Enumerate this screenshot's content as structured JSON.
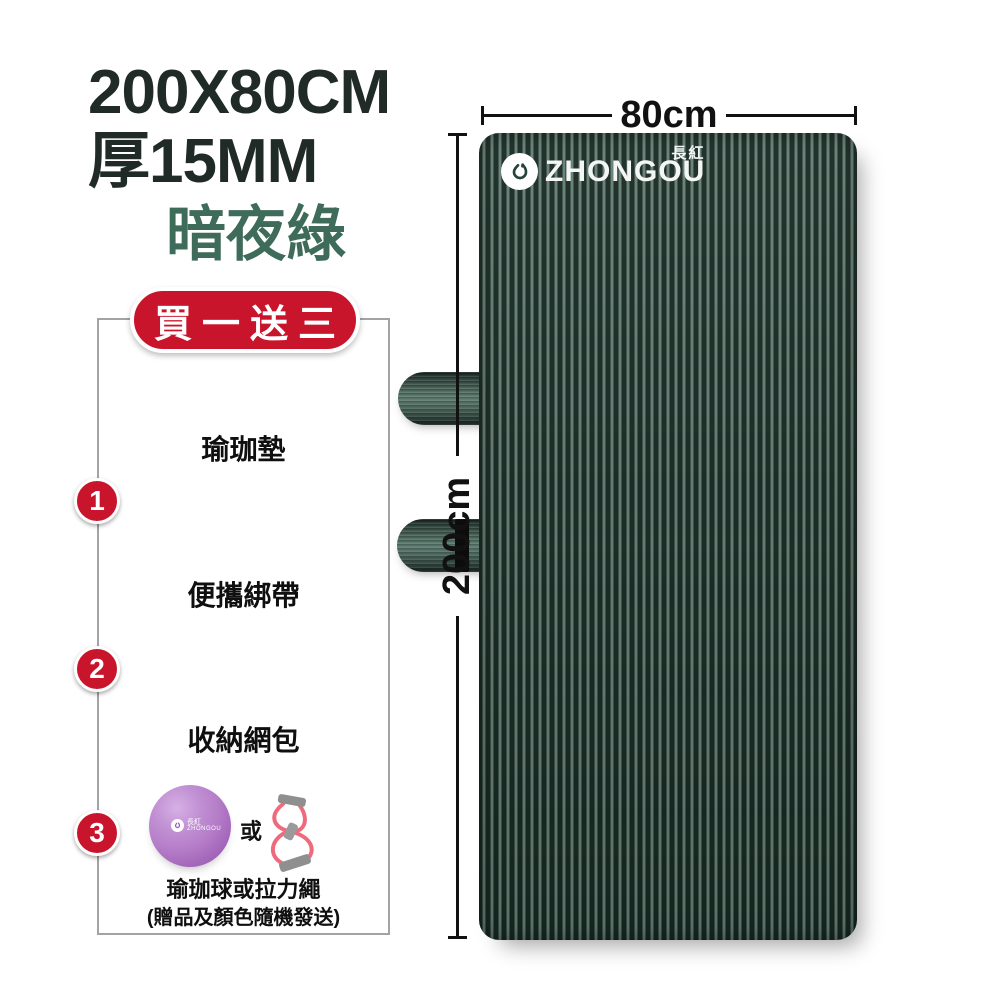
{
  "product": {
    "size_title": "200X80CM",
    "thickness_title": "厚15MM",
    "color_name": "暗夜綠"
  },
  "bundle": {
    "badge_label": "買一送三",
    "plus_symbol": "+",
    "main_item_label": "瑜珈墊",
    "gifts": [
      {
        "number": "1",
        "label": "便攜綁帶"
      },
      {
        "number": "2",
        "label": "收納網包"
      },
      {
        "number": "3",
        "label": "瑜珈球或拉力繩"
      }
    ],
    "or_text": "或",
    "gift_note": "(贈品及顏色隨機發送)"
  },
  "mat_preview": {
    "width_label": "80cm",
    "height_label": "200cm",
    "brand_cn": "長紅",
    "brand_en": "ZHONGOU"
  },
  "ball": {
    "brand_cn": "長紅",
    "brand_en": "ZHONGOU"
  },
  "colors": {
    "accent_red": "#c9152b",
    "title_text": "#202b27",
    "green_title": "#3e6b5a",
    "mat_dark": "#182822",
    "mat_light": "#647f74",
    "ball_purple": "#b77fc9",
    "band_pink": "#ef6a7c"
  }
}
